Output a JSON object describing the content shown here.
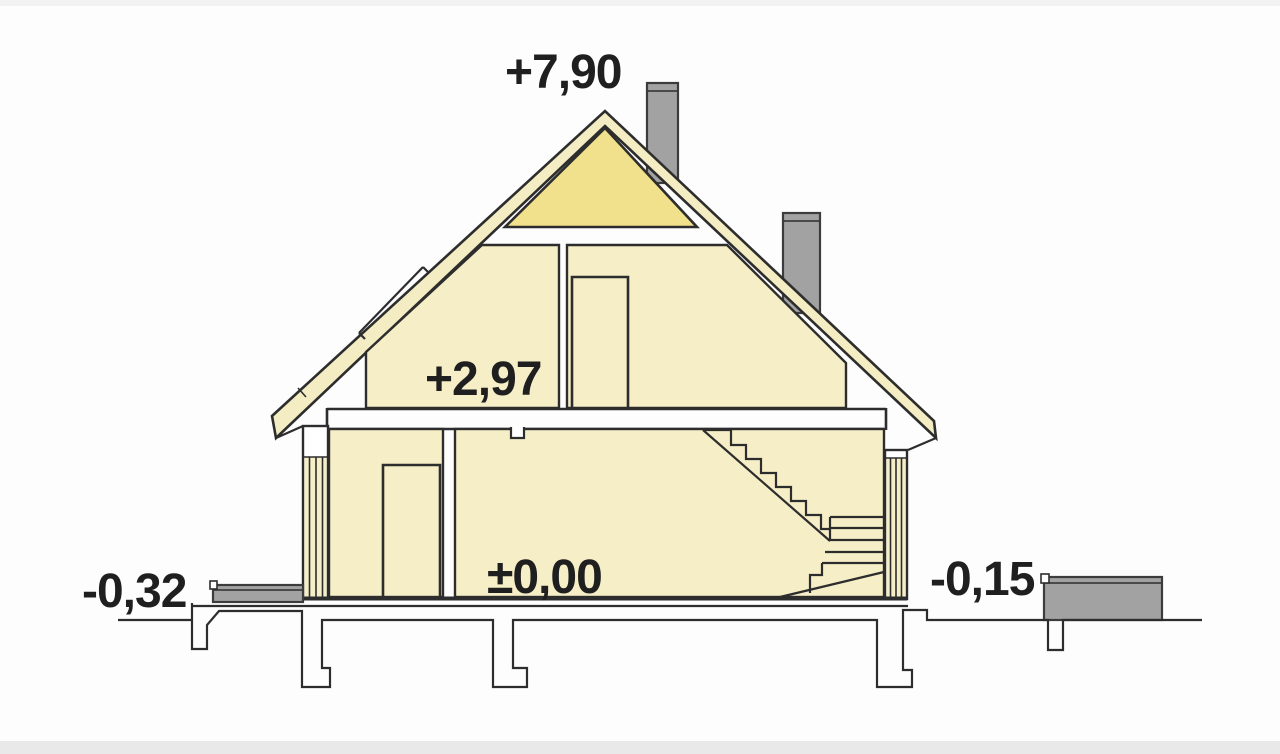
{
  "drawing": {
    "title": "house cross-section elevation drawing",
    "levels": {
      "ridge": "+7,90",
      "attic_floor": "+2,97",
      "ground_floor": "±0,00",
      "terrain_left": "-0,32",
      "terrain_right": "-0,15"
    },
    "colors": {
      "room_fill": "#f6eec6",
      "gable_fill": "#f1e08c",
      "roof_strip": "#f4ecc2",
      "outline": "#2d2d2d",
      "outline_soft": "#3c3c3c",
      "concrete": "#a2a2a2",
      "text": "#1f1f1f"
    }
  }
}
